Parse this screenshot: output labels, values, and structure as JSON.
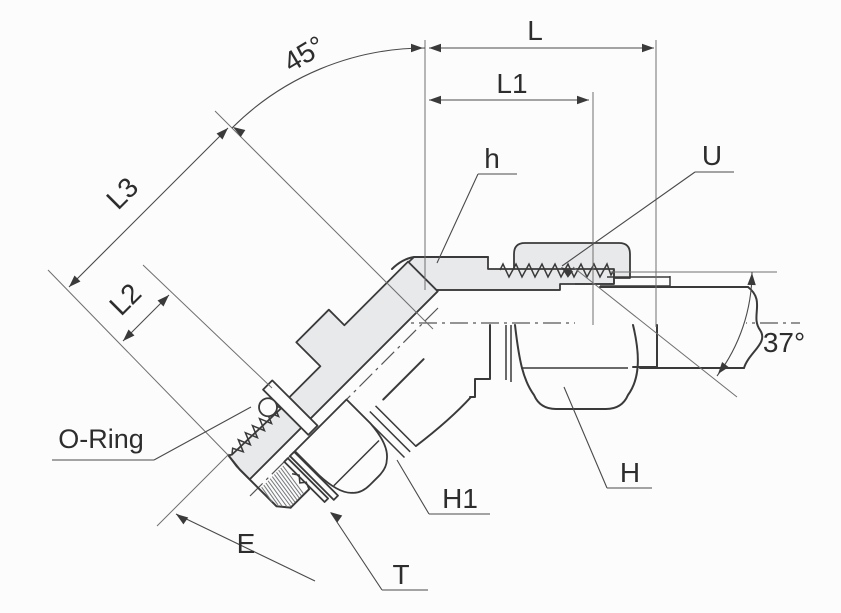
{
  "drawing": {
    "kind": "technical-drawing-45-degree-elbow-fitting",
    "colors": {
      "background": "#fcfcfc",
      "line": "#3a3a3a",
      "thin_line": "#6f6f6f",
      "section_fill": "#e8e9eb",
      "text": "#2d2d2d"
    },
    "labels": {
      "L": "L",
      "L1": "L1",
      "L2": "L2",
      "L3": "L3",
      "angle45": "45°",
      "angle37": "37°",
      "h": "h",
      "U": "U",
      "o_ring": "O-Ring",
      "E": "E",
      "T": "T",
      "H1": "H1",
      "H": "H"
    }
  }
}
